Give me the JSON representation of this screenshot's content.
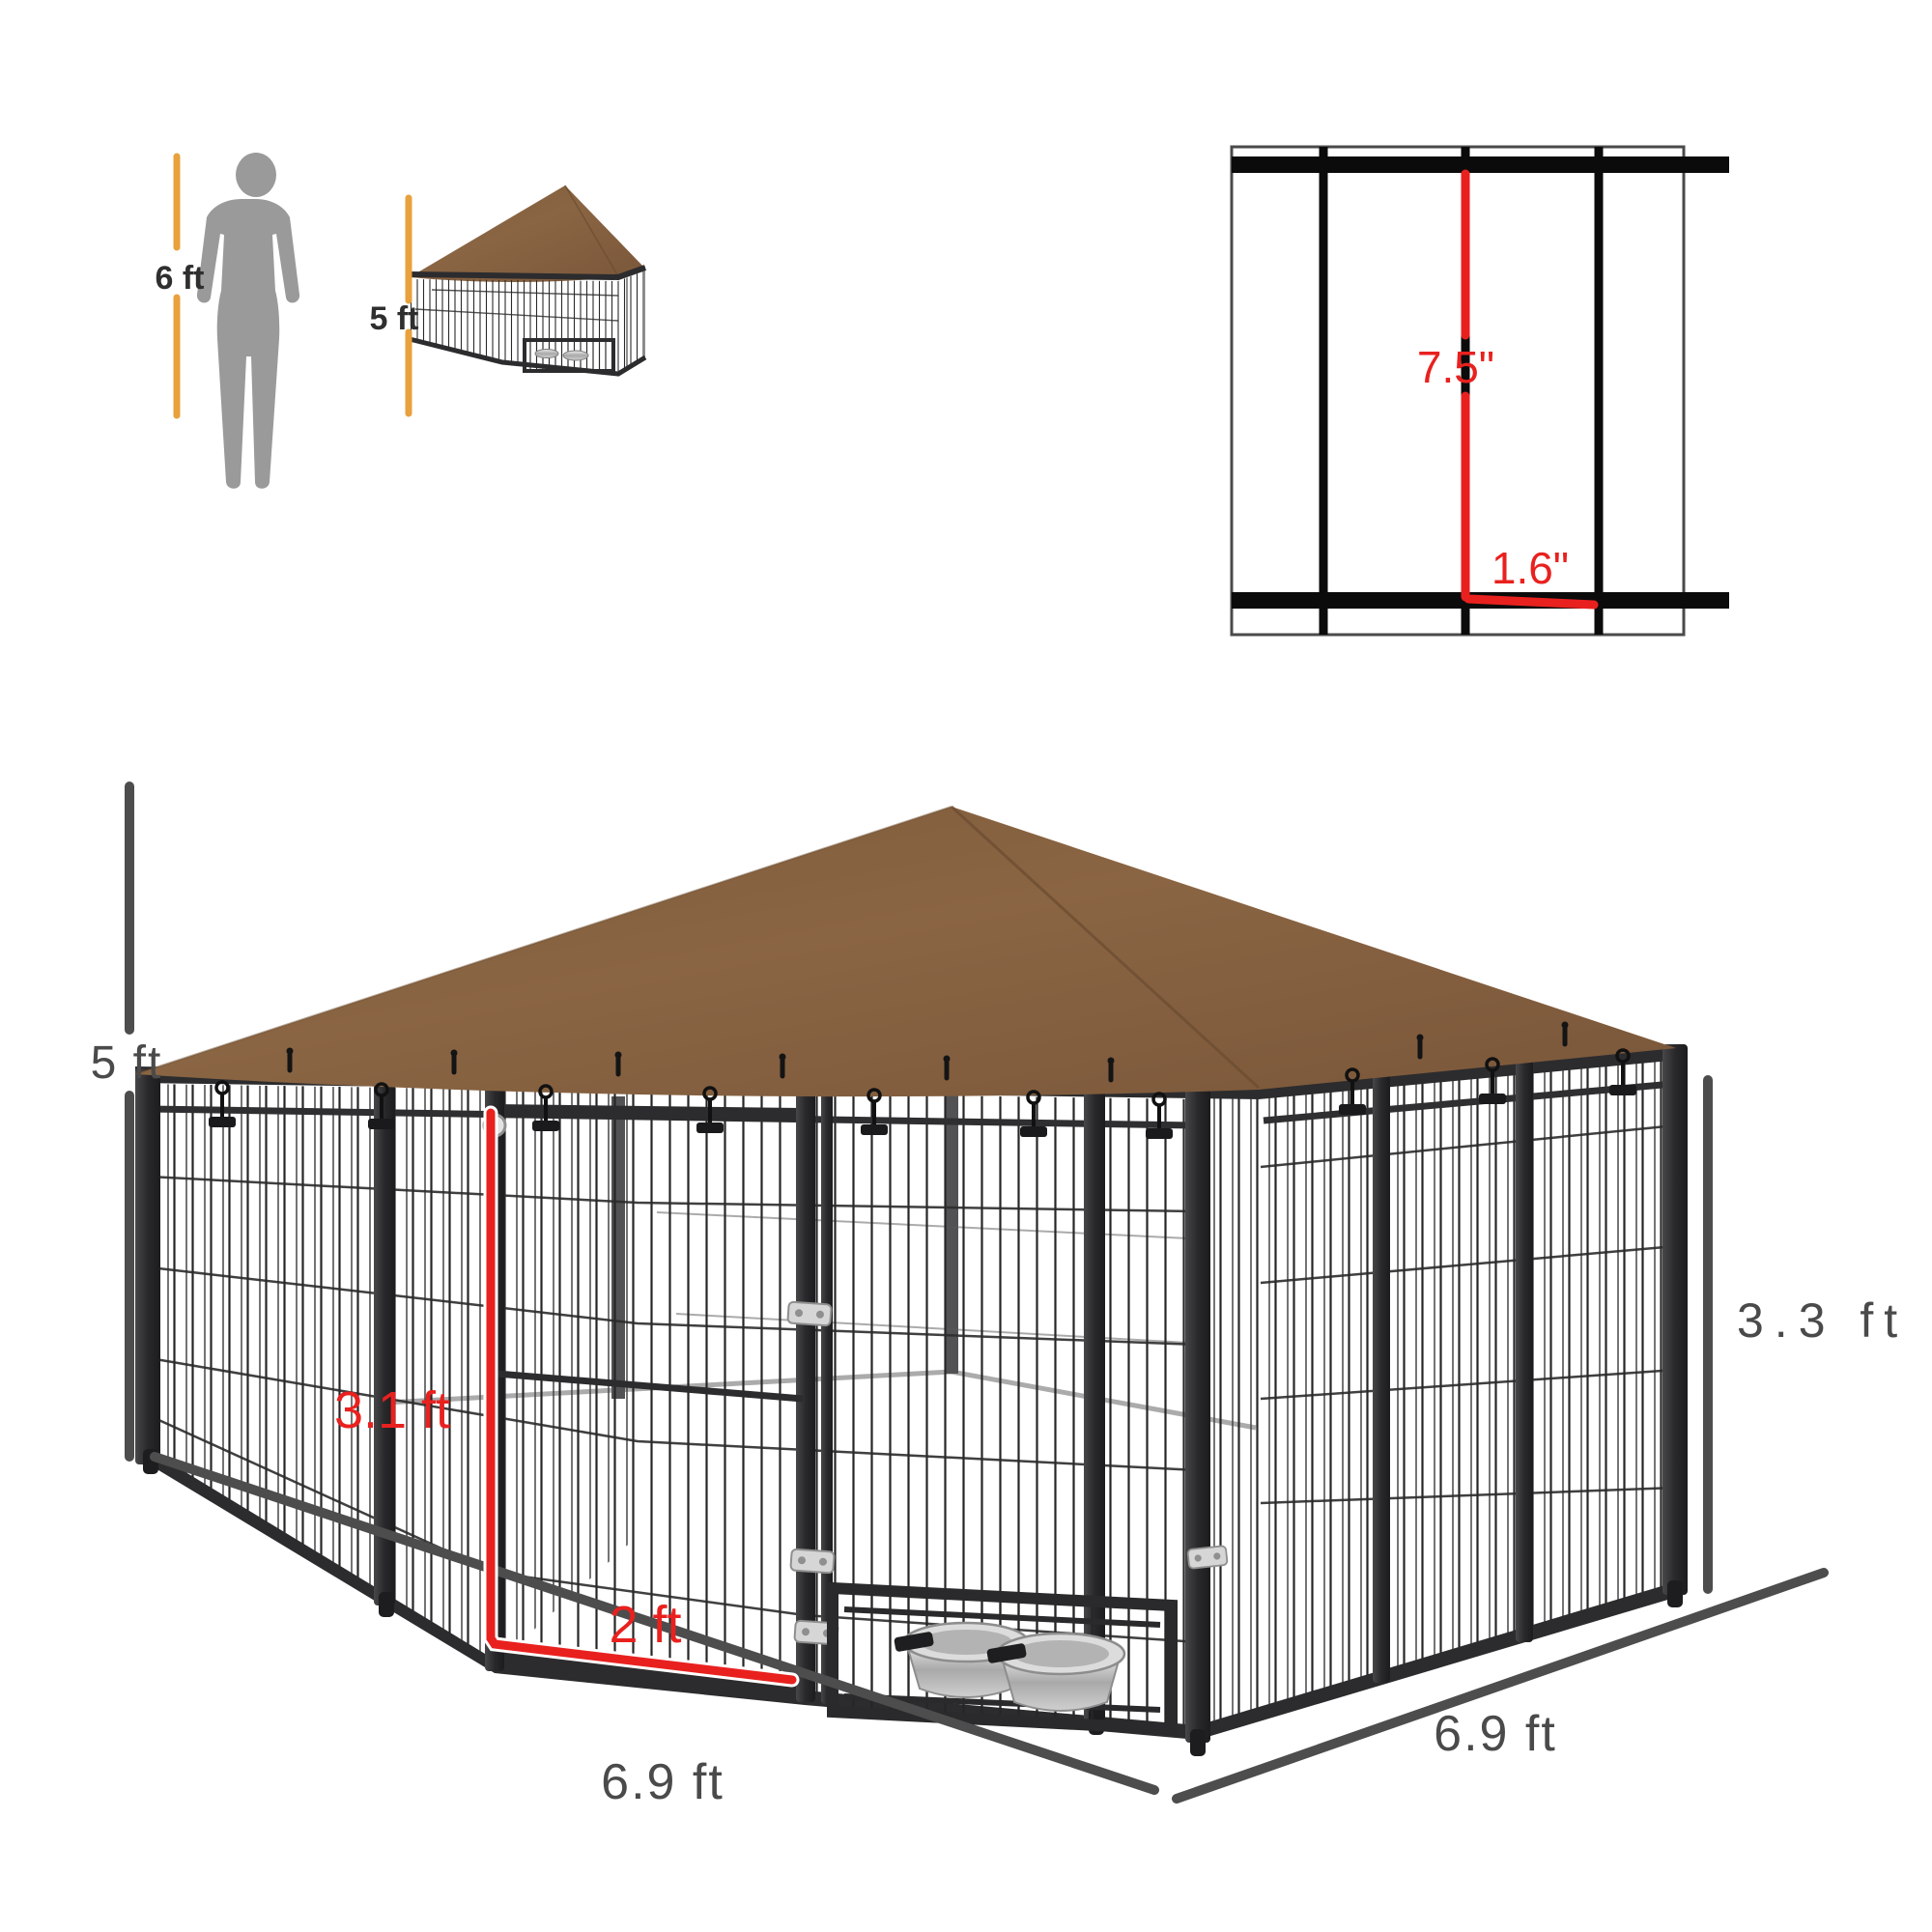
{
  "scale_reference": {
    "person_height": "6 ft",
    "product_height": "5 ft"
  },
  "wire_detail": {
    "vertical_spacing": "7.5\"",
    "horizontal_spacing": "1.6\""
  },
  "dimensions": {
    "overall_height": "5 ft",
    "panel_height": "3.3 ft",
    "door_height": "3.1 ft",
    "door_width": "2 ft",
    "front_width": "6.9 ft",
    "side_depth": "6.9 ft"
  },
  "colors": {
    "canopy_brown": "#86613f",
    "frame_black": "#2c2c2e",
    "dimension_gray": "#4d4d4d",
    "accent_red": "#e8211f",
    "scale_line_amber": "#e8a13c",
    "bowl_silver": "#c9c9c9"
  }
}
